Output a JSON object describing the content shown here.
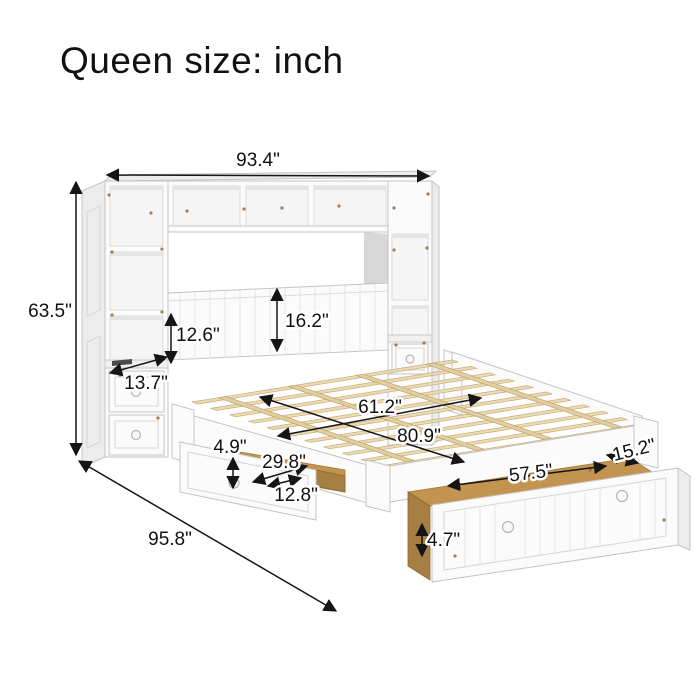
{
  "title": "Queen size: inch",
  "dimensions": {
    "unit_width": "93.4\"",
    "unit_height": "63.5\"",
    "shelf_opening_height": "12.6\"",
    "headboard_height": "16.2\"",
    "tower_depth": "13.7\"",
    "bed_width": "61.2\"",
    "bed_length": "80.9\"",
    "side_drawer_height": "4.9\"",
    "side_drawer_width": "29.8\"",
    "side_drawer_depth": "12.8\"",
    "trundle_width": "57.5\"",
    "trundle_depth": "15.2\"",
    "trundle_height": "4.7\"",
    "total_depth": "95.8\""
  },
  "colors": {
    "annotation": "#151515",
    "furniture_white": "#fbfbfb",
    "wood_slats": "#eadbb5",
    "wood_interior": "#c2944f",
    "background": "#ffffff"
  }
}
